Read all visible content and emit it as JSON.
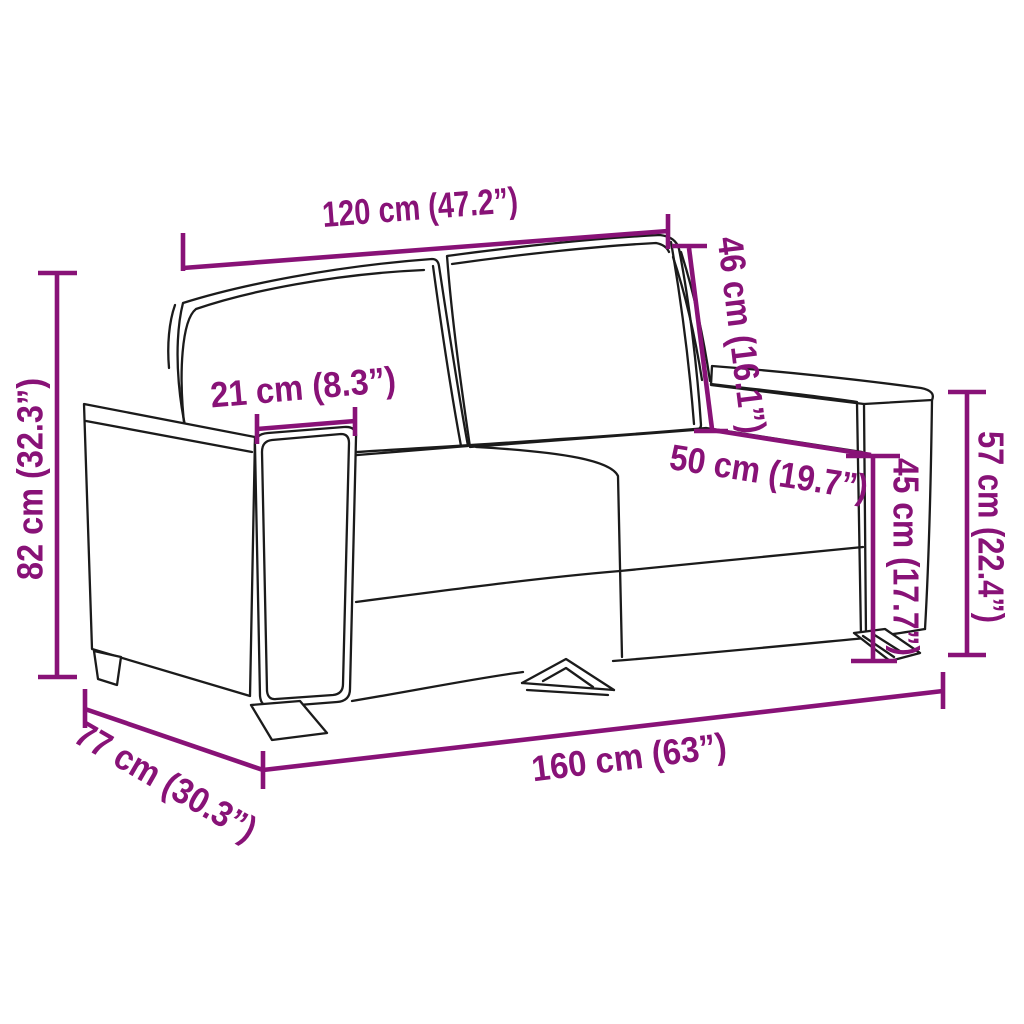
{
  "diagram": {
    "type": "product-dimension-diagram",
    "product": "2-seater sofa line drawing",
    "background_color": "#ffffff",
    "outline_color": "#1b1b1b",
    "accent_color": "#881277",
    "dimensions": [
      {
        "id": "overall-width-top",
        "label": "120 cm (47.2”)",
        "cm": 120,
        "inches": 47.2,
        "measures": "top back width"
      },
      {
        "id": "back-height",
        "label": "46 cm (16.1”)",
        "cm": 46,
        "inches": 16.1,
        "measures": "backrest height"
      },
      {
        "id": "armrest-width",
        "label": "21 cm (8.3”)",
        "cm": 21,
        "inches": 8.3,
        "measures": "armrest width"
      },
      {
        "id": "seat-depth",
        "label": "50 cm (19.7”)",
        "cm": 50,
        "inches": 19.7,
        "measures": "seat depth"
      },
      {
        "id": "seat-height",
        "label": "45 cm (17.7”)",
        "cm": 45,
        "inches": 17.7,
        "measures": "seat height"
      },
      {
        "id": "armrest-height",
        "label": "57 cm (22.4”)",
        "cm": 57,
        "inches": 22.4,
        "measures": "armrest height"
      },
      {
        "id": "overall-height",
        "label": "82 cm (32.3”)",
        "cm": 82,
        "inches": 32.3,
        "measures": "overall height"
      },
      {
        "id": "overall-depth",
        "label": "77 cm (30.3”)",
        "cm": 77,
        "inches": 30.3,
        "measures": "overall depth"
      },
      {
        "id": "overall-width",
        "label": "160 cm (63”)",
        "cm": 160,
        "inches": 63,
        "measures": "overall width"
      }
    ]
  }
}
